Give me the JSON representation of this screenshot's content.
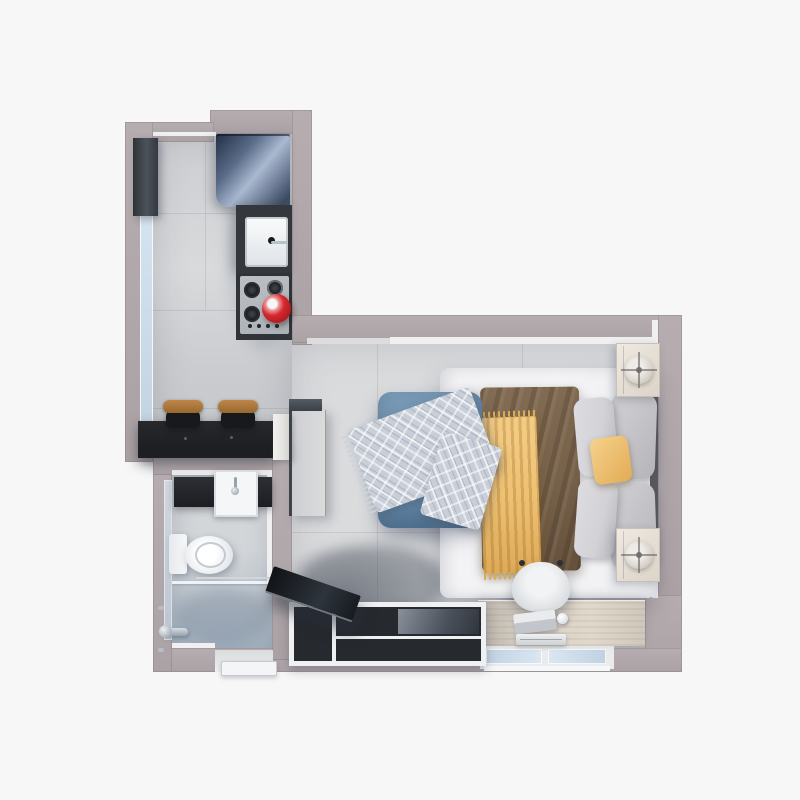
{
  "scene": {
    "kind": "3d-floorplan-top-down-render",
    "unit": "studio-apartment",
    "rooms": [
      "kitchen",
      "bathroom",
      "combined-living-sleeping-area"
    ],
    "furniture": [
      "wall-cabinet",
      "refrigerator",
      "kitchen-sink",
      "cooktop-with-red-pot",
      "breakfast-bar",
      "bar-stool-left",
      "bar-stool-right",
      "wardrobe",
      "bathroom-vanity",
      "bathroom-sink",
      "toilet",
      "shower-with-glass-partition",
      "double-bed",
      "brown-duvet",
      "yellow-throw-blanket",
      "gray-pillows",
      "yellow-pillow",
      "nightstand-top-with-lamp",
      "nightstand-bottom-with-lamp",
      "blue-sofa",
      "blue-pillow",
      "plaid-throw-blanket",
      "desk",
      "desk-chair",
      "laptop",
      "desk-lamp",
      "tv-console",
      "television",
      "entry-door",
      "windows"
    ]
  },
  "palette": {
    "page-bg": "#f7f7f8",
    "wall": "#aba2a5",
    "wall-hi": "#b6adb0",
    "trim": "#f0f0f1",
    "floor-kitchen-a": "#cbcdd0",
    "floor-kitchen-b": "#d8dadc",
    "floor-kitchen-c": "#c2c5c9",
    "floor-bed-a": "#dadbdd",
    "floor-bed-b": "#c8cbcf",
    "floor-bath-a": "#d3d6d9",
    "floor-bath-b": "#a2b1c0",
    "seam": "rgba(100,106,116,0.16)",
    "counter-dark": "#1d1f23",
    "counter-mid": "#34373c",
    "fridge-a": "#223047",
    "fridge-b": "#a9b9d0",
    "fridge-c": "#3d4b64",
    "cooktop": "#bcc0c4",
    "burner": "#131418",
    "pot-red": "#d6282e",
    "pot-red-dark": "#9e161b",
    "stool-wood-a": "#c08648",
    "stool-wood-b": "#96682f",
    "stool-base": "#17191c",
    "wood-a": "#cdc4b6",
    "wood-grain": "rgba(120,104,82,0.18)",
    "white-panel": "#f2f1ef",
    "sheet": "#f3f3f5",
    "duvet": "#77614a",
    "duvet-dark": "rgba(34,24,14,0.16)",
    "throw-yellow": "#eec173",
    "throw-yellow-dark": "rgba(157,102,34,0.3)",
    "pillow-gray-a": "#d3d2d6",
    "pillow-gray-b": "#b5b4b9",
    "pillow-yellow-a": "#f6d28c",
    "pillow-yellow-b": "#e2ab55",
    "sofa-blue-a": "#7b9cb8",
    "sofa-blue-b": "#54799a",
    "pillow-blue-a": "#86a8c4",
    "pillow-blue-b": "#6590b0",
    "plaid-base": "#c9cfd8",
    "nightstand-a": "#efe9e2",
    "nightstand-b": "#dcd4c8",
    "lamp-a": "#efece7",
    "lamp-b": "#b5b0a6",
    "desk-a": "#e0d8cb",
    "desk-b": "#b7b1a9",
    "console-frame": "#eef0f2",
    "console-dark": "#26292e",
    "tv-a": "#101215",
    "tv-b": "#2e343c",
    "chair-a": "#f2f3f4",
    "chair-b": "#c9cdd1",
    "glass-a": "#dbe7f2",
    "glass-b": "#c0d1e1",
    "chrome": "#b9c1c9",
    "porcelain": "#f5f6f8"
  }
}
